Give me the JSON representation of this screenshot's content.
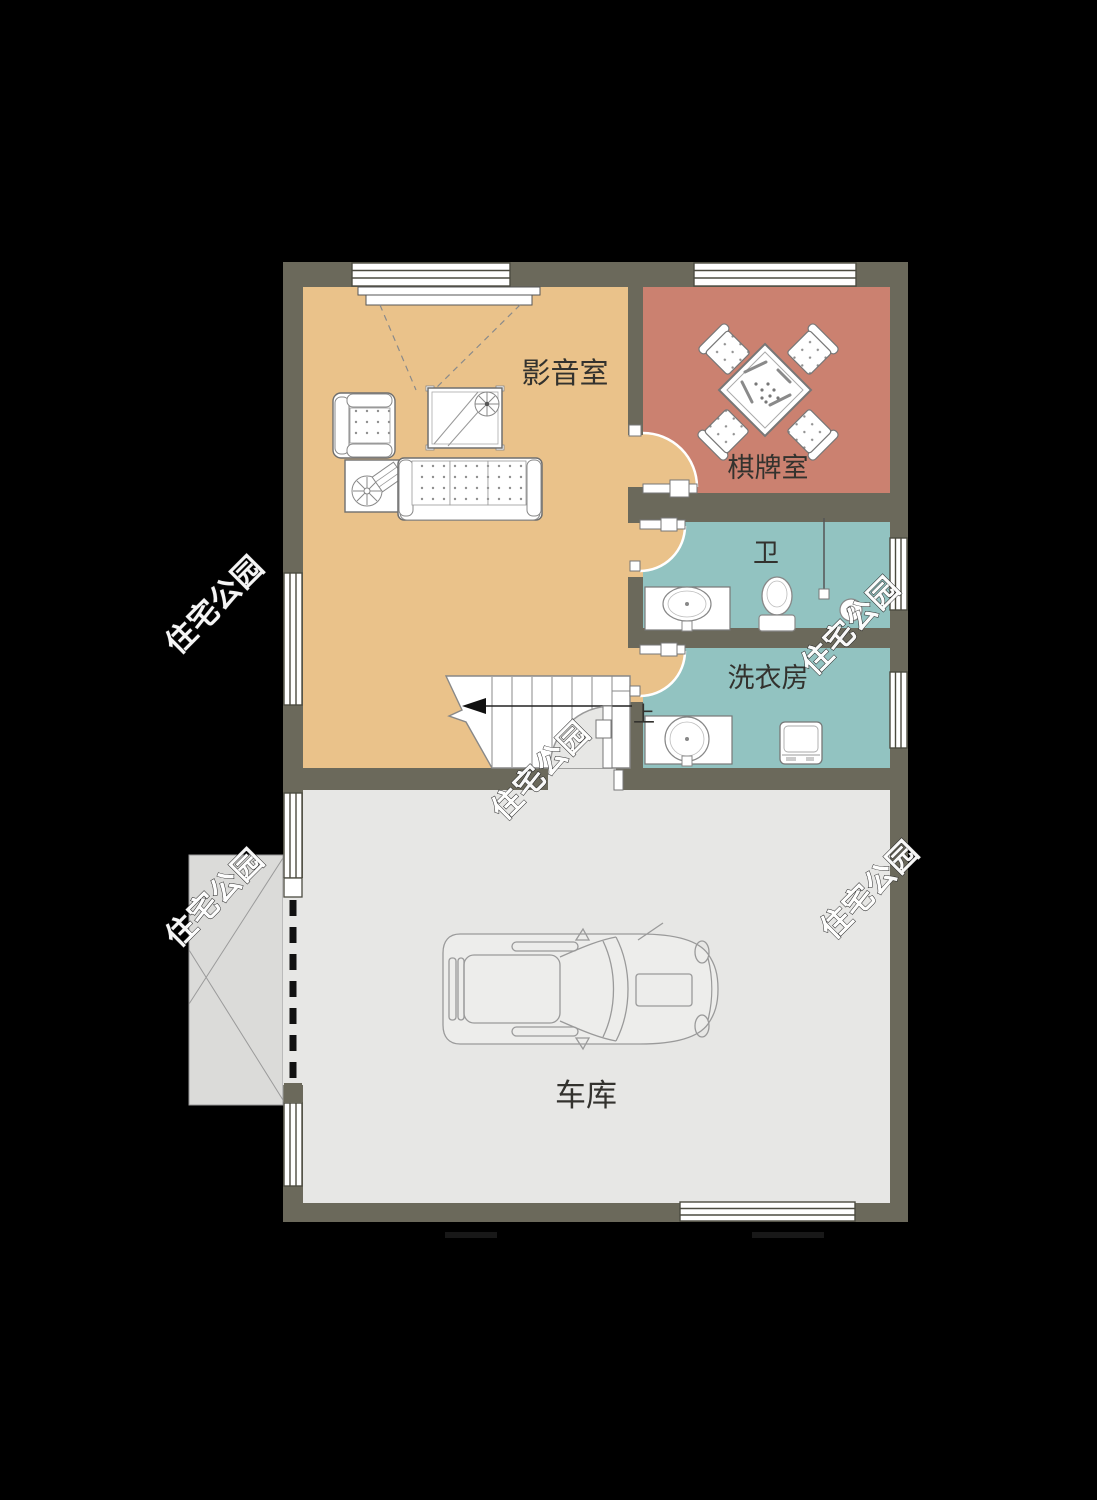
{
  "page": {
    "type": "residential-floor-plan",
    "background": "#000000"
  },
  "palette": {
    "wall": "#6B695B",
    "media_room_floor": "#EAC28A",
    "chess_room_floor": "#CB8170",
    "wet_room_floor": "#92C3C1",
    "garage_floor": "#E7E7E5",
    "ramp": "#DBDBD9",
    "furniture": "#FFFFFF",
    "label_text": "#33322E"
  },
  "rooms": [
    {
      "id": "media",
      "label": "影音室"
    },
    {
      "id": "chess",
      "label": "棋牌室"
    },
    {
      "id": "bath",
      "label": "卫"
    },
    {
      "id": "laundry",
      "label": "洗衣房"
    },
    {
      "id": "garage",
      "label": "车库"
    }
  ],
  "stairs": {
    "up_label": "上"
  },
  "watermark": {
    "text": "住宅公园",
    "count": 5
  }
}
